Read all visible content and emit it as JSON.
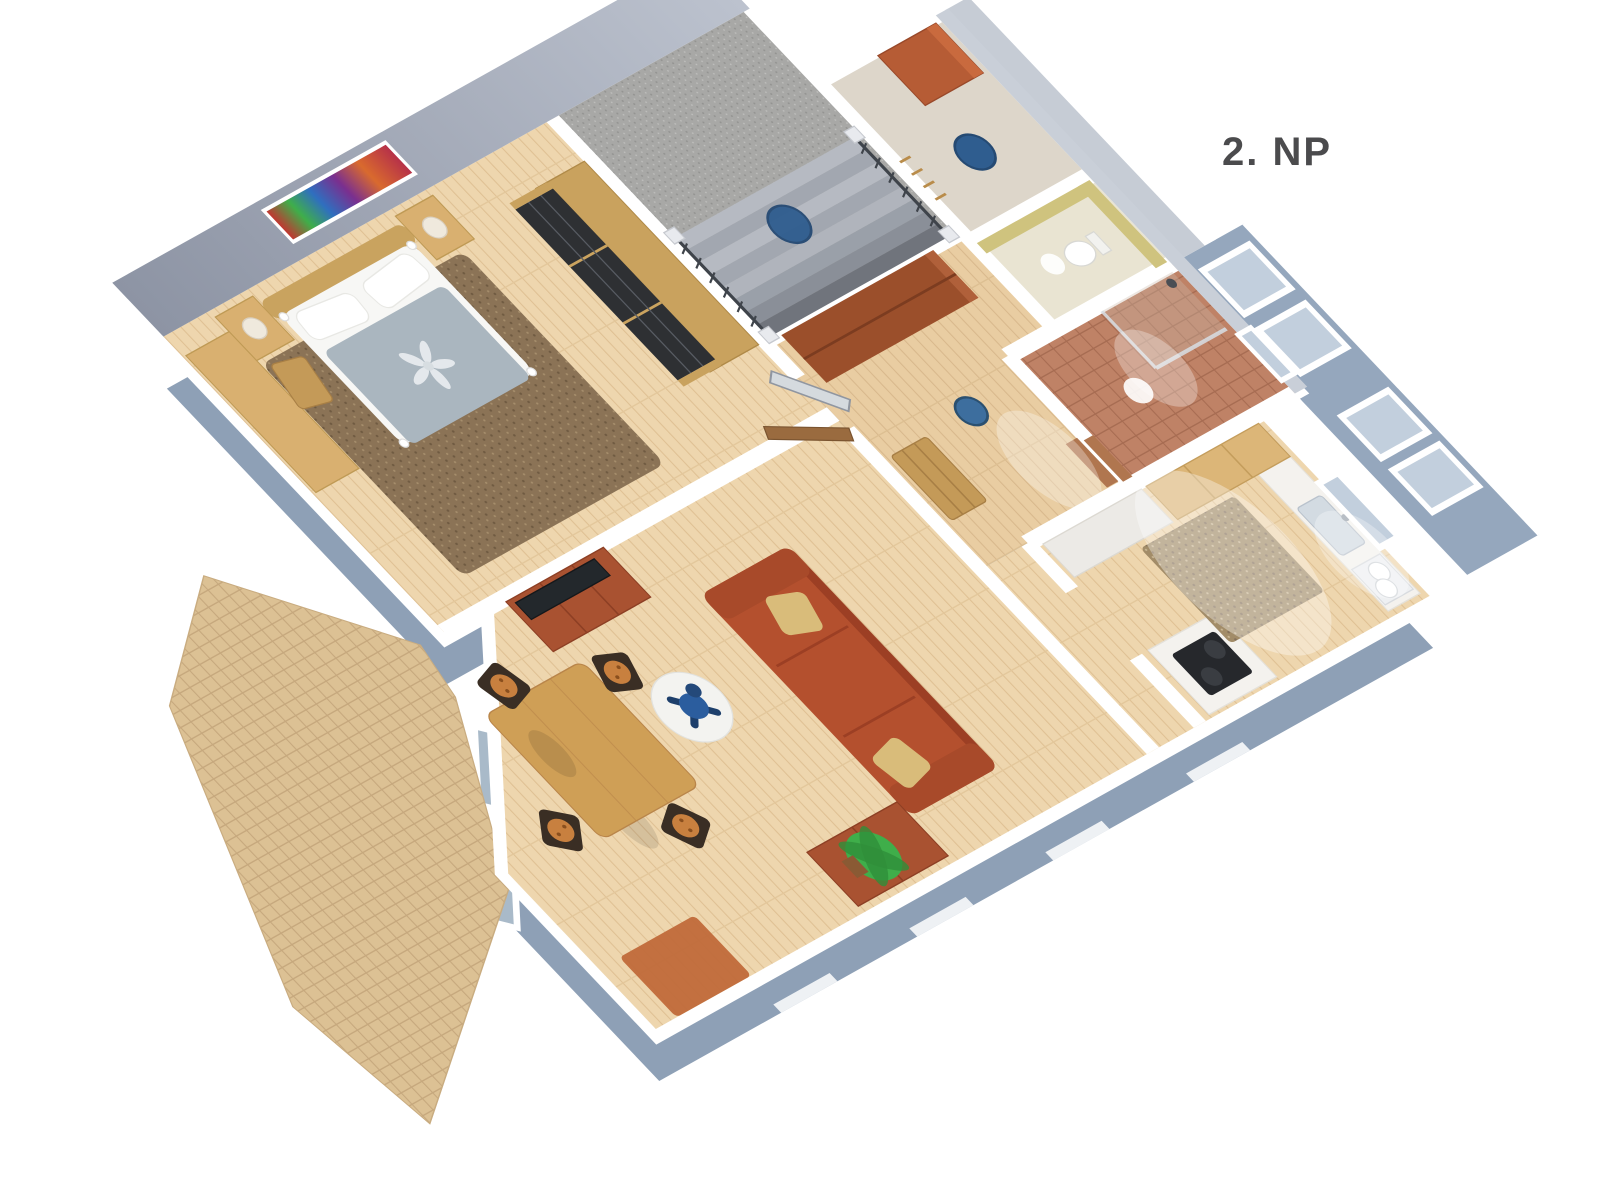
{
  "floor_label": {
    "text": "2. NP"
  },
  "scene": {
    "kind": "3d-floor-plan-render",
    "view": "axonometric-birds-eye"
  },
  "colors": {
    "background": "#ffffff",
    "label": "#4b4b4d",
    "exterior_wall": "#8ea0b6",
    "wall_top": "#ffffff",
    "wall_face": "#9fa7b6",
    "floor_wood": "#eed6ae",
    "floor_wood_warm": "#e9cda2",
    "carpet_gray": "#a8a8a6",
    "rug_brown": "#8b7356",
    "tile_terracotta": "#bf8266",
    "tile_terrace": "#dcc194",
    "sofa_rust": "#b4502e",
    "tv_stand": "#a95231",
    "cherry_cabinet": "#9b4f2b",
    "oak_furniture": "#d9b070",
    "wardrobe_dark": "#2e3033",
    "accent_blue": "#2f5d8f",
    "plant_green": "#3fae4a",
    "window_glass": "#c2cfdd"
  }
}
